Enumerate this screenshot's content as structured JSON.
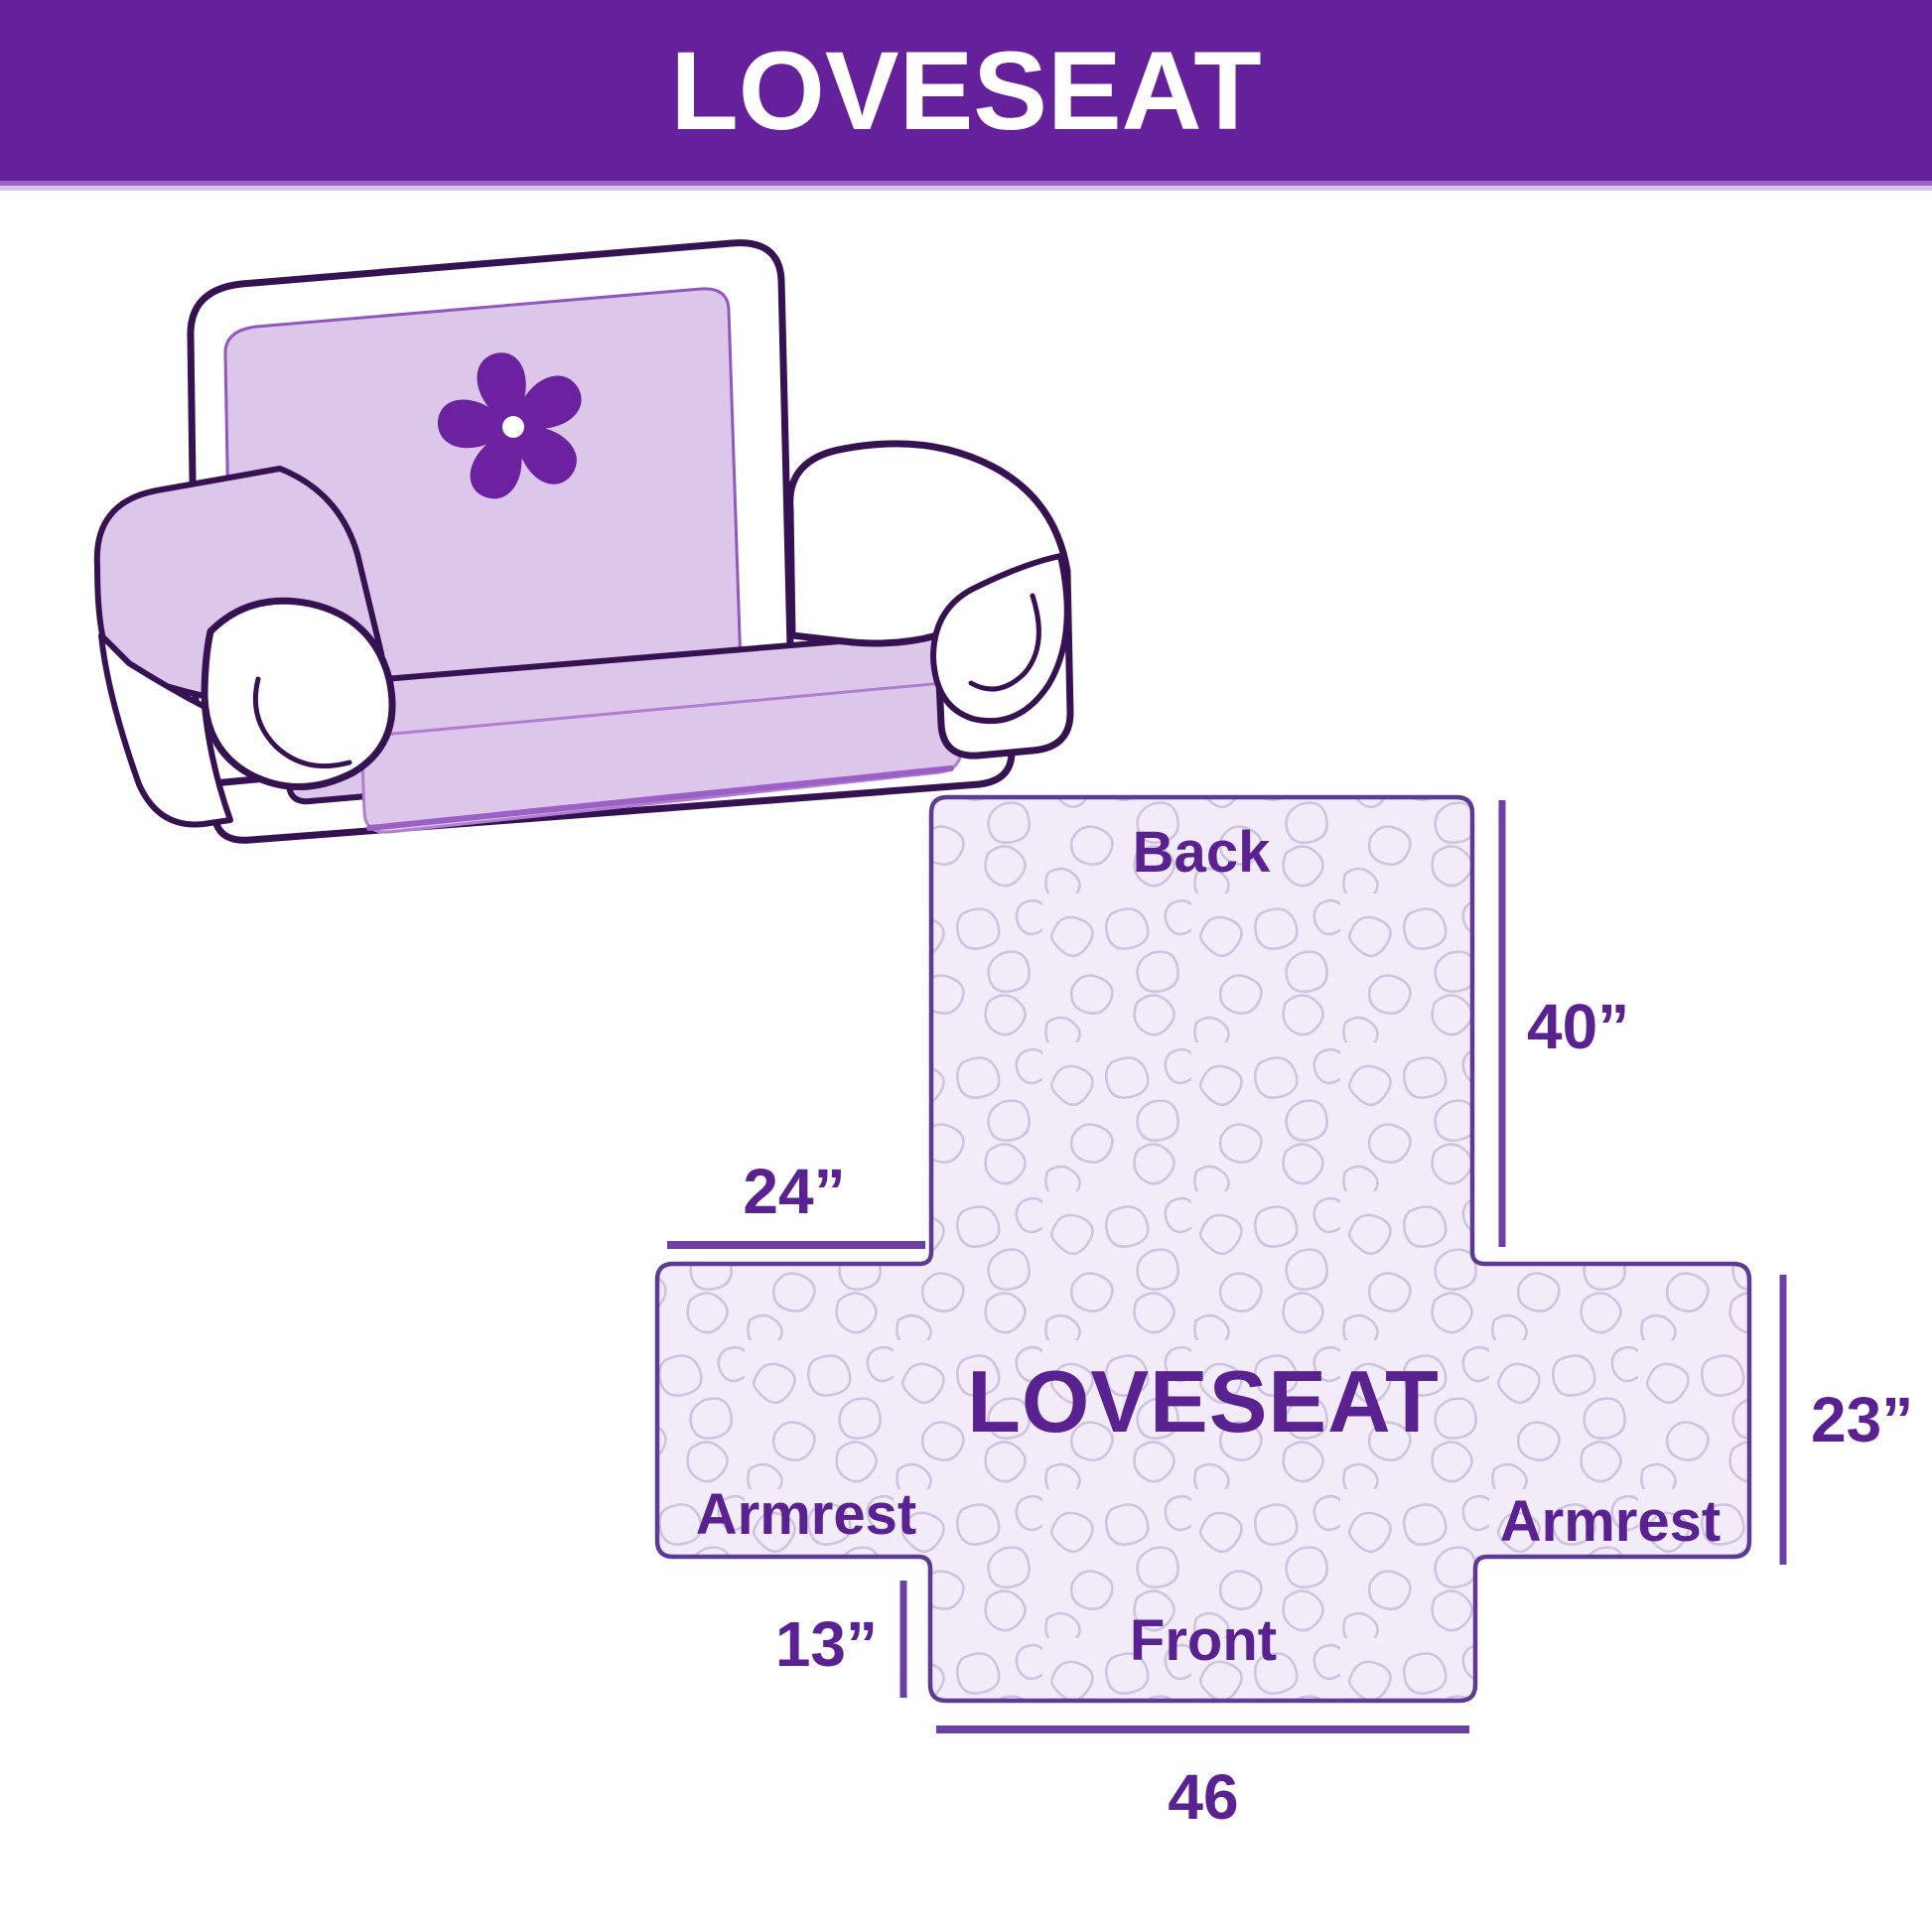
{
  "header": {
    "title": "LOVESEAT",
    "bg_color": "#65209C",
    "text_color": "#FFFFFF"
  },
  "illustration": {
    "description": "hand-drawn loveseat sofa with lavender protective cover on backrest, seat and left armrest",
    "pinwheel_logo_color": "#6B21A0",
    "cover_color": "#DCC7EB",
    "outline_color": "#361252"
  },
  "diagram": {
    "product_label": "LOVESEAT",
    "fill_color": "#F1ECF8",
    "pattern_color": "#CEC4E0",
    "border_color": "#5E3A96",
    "label_color": "#5A2191",
    "sections": {
      "back": "Back",
      "front": "Front",
      "armrest_left": "Armrest",
      "armrest_right": "Armrest"
    },
    "dimensions": {
      "back_height": "40”",
      "armrest_width": "24”",
      "armrest_depth": "23”",
      "front_drop": "13”",
      "front_width": "46"
    }
  }
}
